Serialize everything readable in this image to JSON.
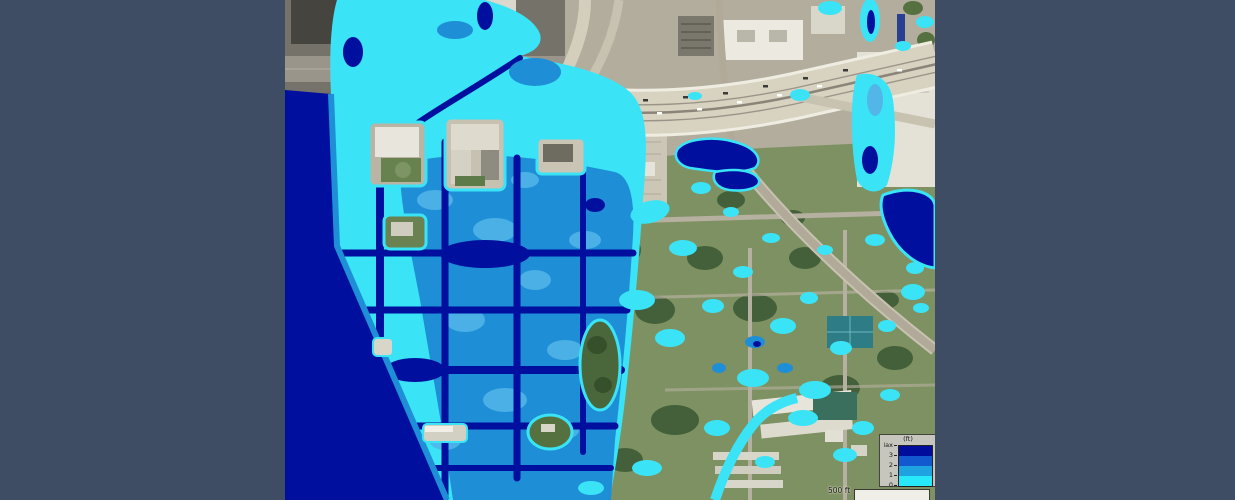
{
  "colors": {
    "frame": "#3e4d64",
    "flood_shallow": "#3ae4f6",
    "flood_light": "#52b6e8",
    "flood_medium": "#1e8ed6",
    "flood_deep": "#000f9e"
  },
  "legend": {
    "title": "(ft)",
    "tick_labels": [
      "Max",
      "3",
      "2",
      "1",
      "0"
    ],
    "band_colors": [
      "#000d9c",
      "#1258cf",
      "#1fa3e0",
      "#28e9fb"
    ]
  },
  "scale_bar": {
    "label": "500 ft"
  }
}
